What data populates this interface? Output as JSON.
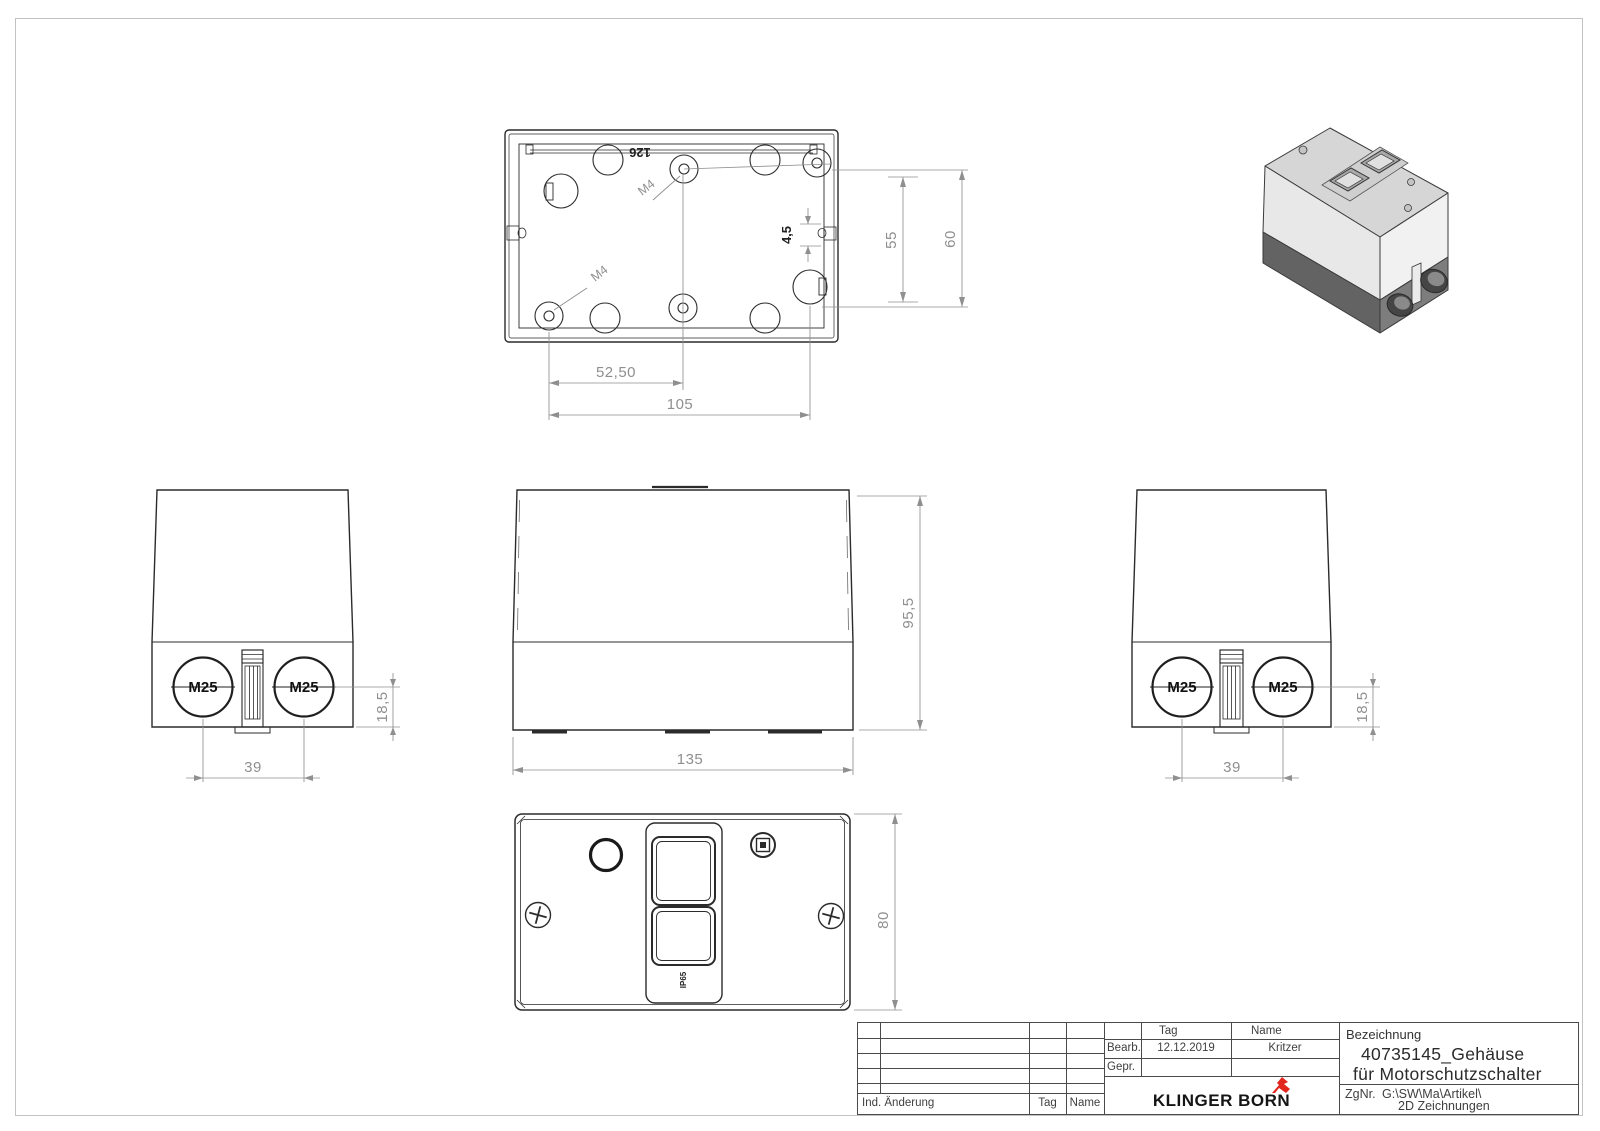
{
  "drawing": {
    "views": {
      "top": {
        "marking": "126",
        "thread_labels": [
          "M4",
          "M4"
        ],
        "dims": {
          "pitch_x_half": "52,50",
          "pitch_x": "105",
          "pitch_y": "55",
          "height": "60",
          "slot": "4,5"
        }
      },
      "front": {
        "dims": {
          "width": "135",
          "height": "95,5"
        }
      },
      "side_left": {
        "glands": [
          "M25",
          "M25"
        ],
        "dims": {
          "gland_center": "18,5",
          "gland_pitch": "39"
        }
      },
      "side_right": {
        "glands": [
          "M25",
          "M25"
        ],
        "dims": {
          "gland_center": "18,5",
          "gland_pitch": "39"
        }
      },
      "bottom": {
        "ip_rating": "IP65",
        "dims": {
          "depth": "80"
        }
      }
    },
    "title_block": {
      "bezeichnung_label": "Bezeichnung",
      "title_line1": "40735145_Gehäuse",
      "title_line2": "für Motorschutzschalter",
      "zgnr_label": "ZgNr.",
      "zgnr_path_line1": "G:\\SW\\Ma\\Artikel\\",
      "zgnr_path_line2": "2D Zeichnungen",
      "col_tag": "Tag",
      "col_name": "Name",
      "row_bearb": "Bearb.",
      "row_gepr": "Gepr.",
      "bearb_date": "12.12.2019",
      "bearb_name": "Kritzer",
      "rev_label": "Ind. Änderung",
      "rev_tag": "Tag",
      "rev_name": "Name",
      "company": "KLINGER BORN"
    },
    "colors": {
      "line": "#2b2b2b",
      "dim": "#8f8f8f",
      "accent_red": "#e2261d"
    }
  }
}
